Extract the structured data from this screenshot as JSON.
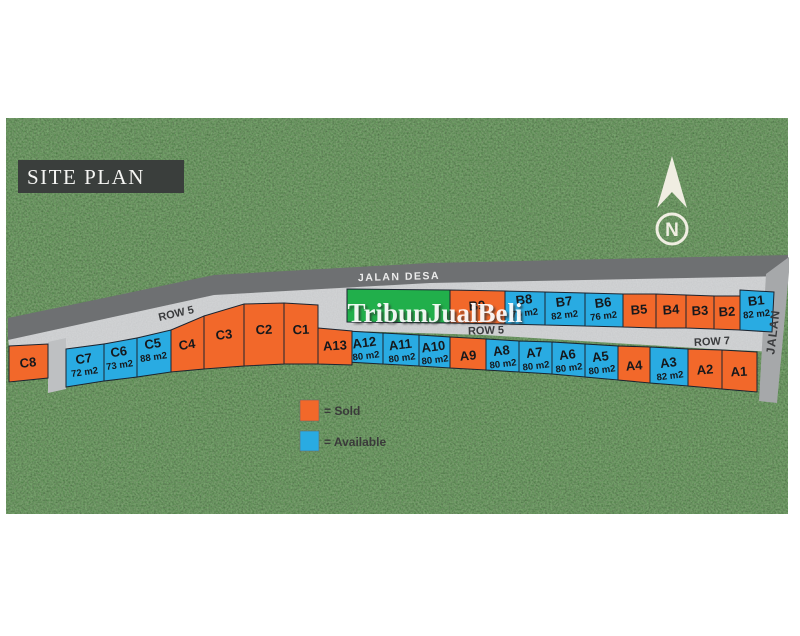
{
  "title": "SITE PLAN",
  "compass_label": "N",
  "watermark": {
    "text": "TribunJualBeli"
  },
  "roads": {
    "jalan_desa": "JALAN DESA",
    "row5_left": "ROW 5",
    "row5_center": "ROW 5",
    "row7": "ROW 7",
    "jalan_side": "JALAN"
  },
  "legend": {
    "sold": "= Sold",
    "available": "= Available"
  },
  "colors": {
    "sold": "#F2682A",
    "available": "#29ABE2",
    "green_lot": "#21AF4B"
  },
  "lots": {
    "C8": {
      "label": "C8",
      "status": "sold"
    },
    "C7": {
      "label": "C7",
      "area": "72 m2",
      "status": "available"
    },
    "C6": {
      "label": "C6",
      "area": "73 m2",
      "status": "available"
    },
    "C5": {
      "label": "C5",
      "area": "88 m2",
      "status": "available"
    },
    "C4": {
      "label": "C4",
      "status": "sold"
    },
    "C3": {
      "label": "C3",
      "status": "sold"
    },
    "C2": {
      "label": "C2",
      "status": "sold"
    },
    "C1": {
      "label": "C1",
      "status": "sold"
    },
    "A13": {
      "label": "A13",
      "status": "sold"
    },
    "A12": {
      "label": "A12",
      "area": "80 m2",
      "status": "available"
    },
    "A11": {
      "label": "A11",
      "area": "80 m2",
      "status": "available"
    },
    "A10": {
      "label": "A10",
      "area": "80 m2",
      "status": "available"
    },
    "A9": {
      "label": "A9",
      "status": "sold"
    },
    "A8": {
      "label": "A8",
      "area": "80 m2",
      "status": "available"
    },
    "A7": {
      "label": "A7",
      "area": "80 m2",
      "status": "available"
    },
    "A6": {
      "label": "A6",
      "area": "80 m2",
      "status": "available"
    },
    "A5": {
      "label": "A5",
      "area": "80 m2",
      "status": "available"
    },
    "A4": {
      "label": "A4",
      "status": "sold"
    },
    "A3": {
      "label": "A3",
      "area": "82 m2",
      "status": "available"
    },
    "A2": {
      "label": "A2",
      "status": "sold"
    },
    "A1": {
      "label": "A1",
      "status": "sold"
    },
    "B9": {
      "label": "B9",
      "status": "sold"
    },
    "B8": {
      "label": "B8",
      "area": "78 m2",
      "status": "available"
    },
    "B7": {
      "label": "B7",
      "area": "82 m2",
      "status": "available"
    },
    "B6": {
      "label": "B6",
      "area": "76 m2",
      "status": "available"
    },
    "B5": {
      "label": "B5",
      "status": "sold"
    },
    "B4": {
      "label": "B4",
      "status": "sold"
    },
    "B3": {
      "label": "B3",
      "status": "sold"
    },
    "B2": {
      "label": "B2",
      "status": "sold"
    },
    "B1": {
      "label": "B1",
      "area": "82 m2",
      "status": "available"
    }
  }
}
